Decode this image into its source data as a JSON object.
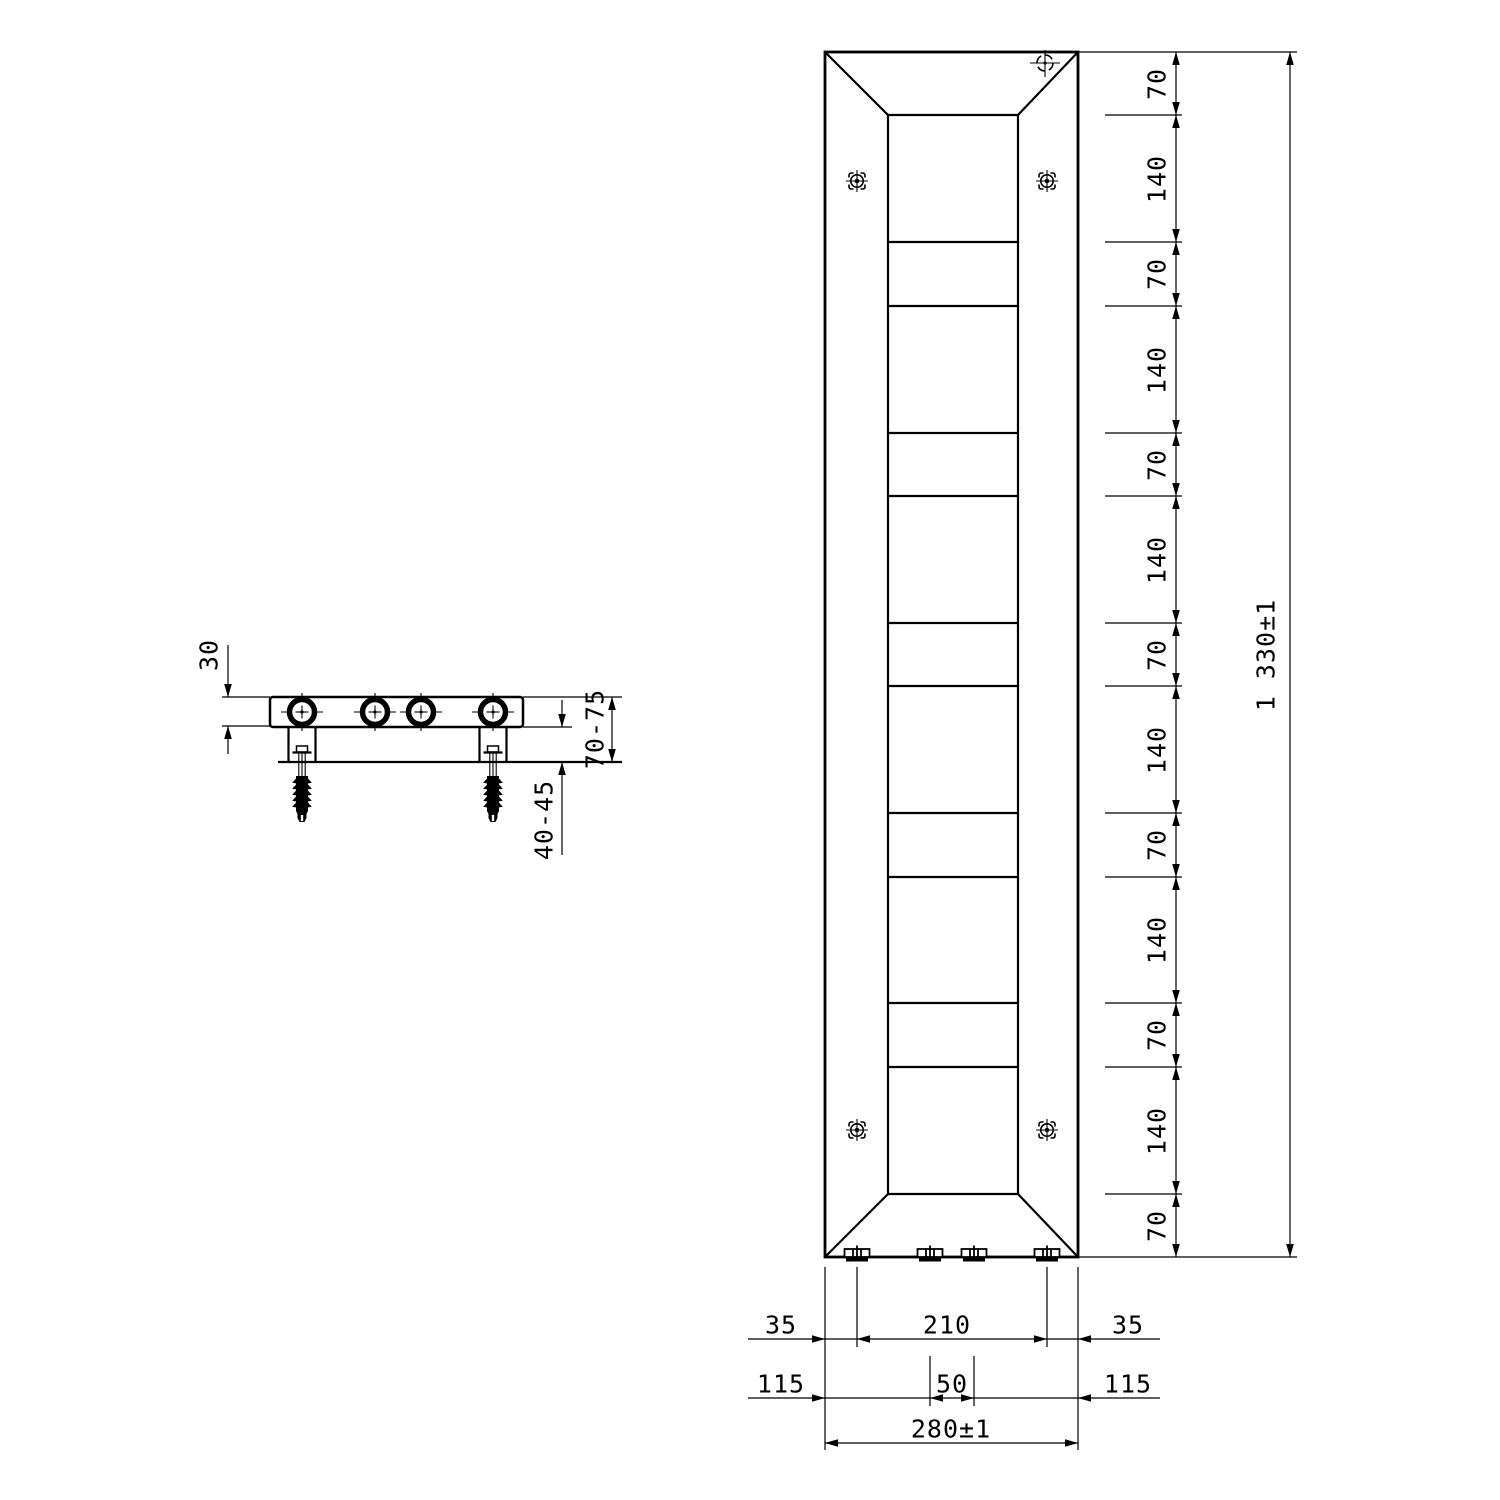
{
  "drawing": {
    "type": "technical-dimension-drawing",
    "subject": "vertical panel radiator with wall mounting bracket",
    "colors": {
      "line": "#000000",
      "background": "#ffffff"
    },
    "symbols": {
      "mounting_point": "target-crosshair-in-dashed-square",
      "air_vent": "dashed-circle-crosshair",
      "pipe_connection": "thick-ring-crosshair-circle"
    }
  },
  "front": {
    "total_height": "1 330±1",
    "total_width": "280±1",
    "chain": [
      "70",
      "140",
      "70",
      "140",
      "70",
      "140",
      "70",
      "140",
      "70",
      "140",
      "70",
      "140",
      "70"
    ],
    "row1": [
      "35",
      "210",
      "35"
    ],
    "row2": [
      "115",
      "50",
      "115"
    ]
  },
  "side": {
    "depth": "30",
    "front_to_wall": "70-75",
    "anchor_embed": "40-45"
  }
}
